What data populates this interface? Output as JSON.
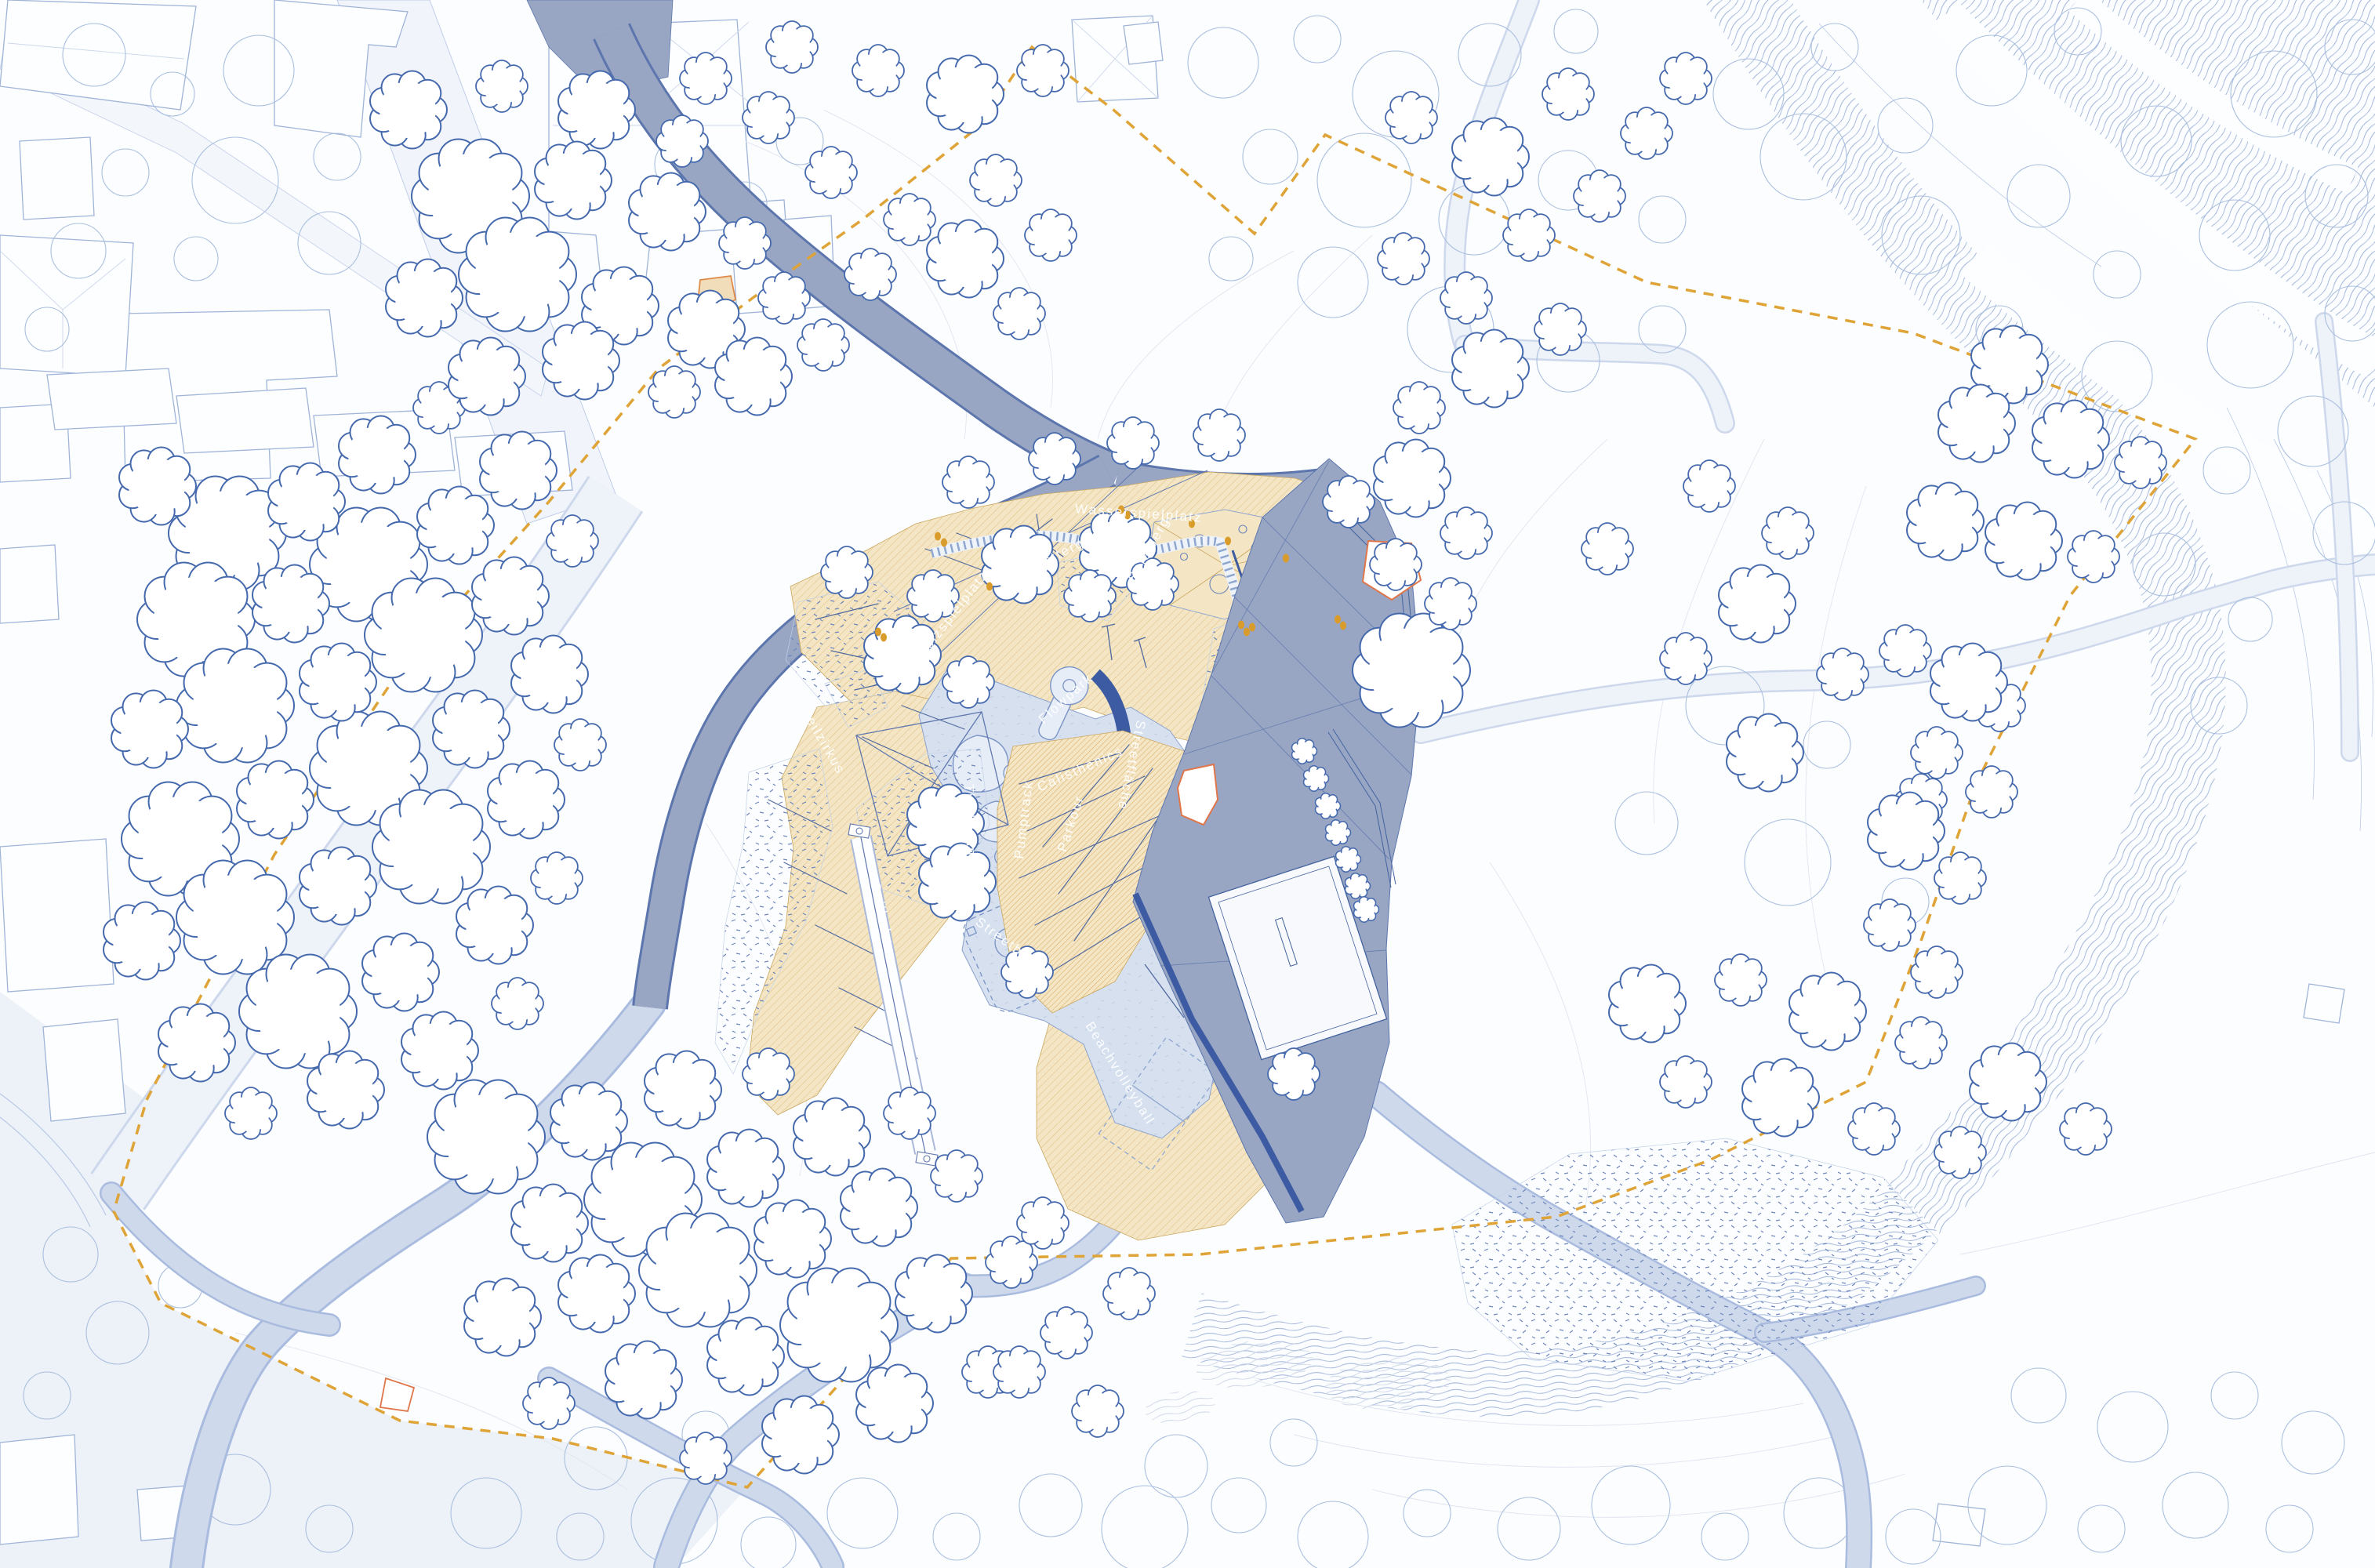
{
  "plan_labels": {
    "wasserspielplatz": "Wasserspielplatz",
    "spielberg": "Spielberg",
    "klettergeruest": "Klettergerüst",
    "treibholzspielplatz": "Treibholzspielplatz",
    "seilzirkus": "Seilzirkus",
    "holzstrudel": "Holzstrudel",
    "seilbahn": "Seilbahn",
    "flowpark": "Flowpark",
    "calisthenics": "Calisthenics",
    "parkour": "Parkour",
    "pumptrack": "Pumptrack",
    "tischtennis": "Tischtennis",
    "streetflaeche": "Streetfläche",
    "streetball": "Streetball",
    "beachvolleyball": "Beachvolleyball"
  },
  "colors": {
    "background": "#fcfdff",
    "tree_outline": "#4569ad",
    "existing_tree": "#aabfdf",
    "context_building": "#9fb4d8",
    "gray_path": "#98a6c4",
    "gray_path_edge": "#5c76ad",
    "play_sand": "#f4e6c4",
    "sand_hatch": "#dfbe83",
    "skate_concrete": "#d6e0ef",
    "skate_lines": "#7b94c6",
    "dark_blue_wall": "#3d5ba2",
    "walk_path": "#cfd9ec",
    "meadow_path": "#eef2f9",
    "site_boundary": "#dfa437",
    "highlight_structure": "#e0764a",
    "people": "#d99c2b",
    "stream_hatch": "#9db2d8",
    "label_text": "#ffffff"
  }
}
